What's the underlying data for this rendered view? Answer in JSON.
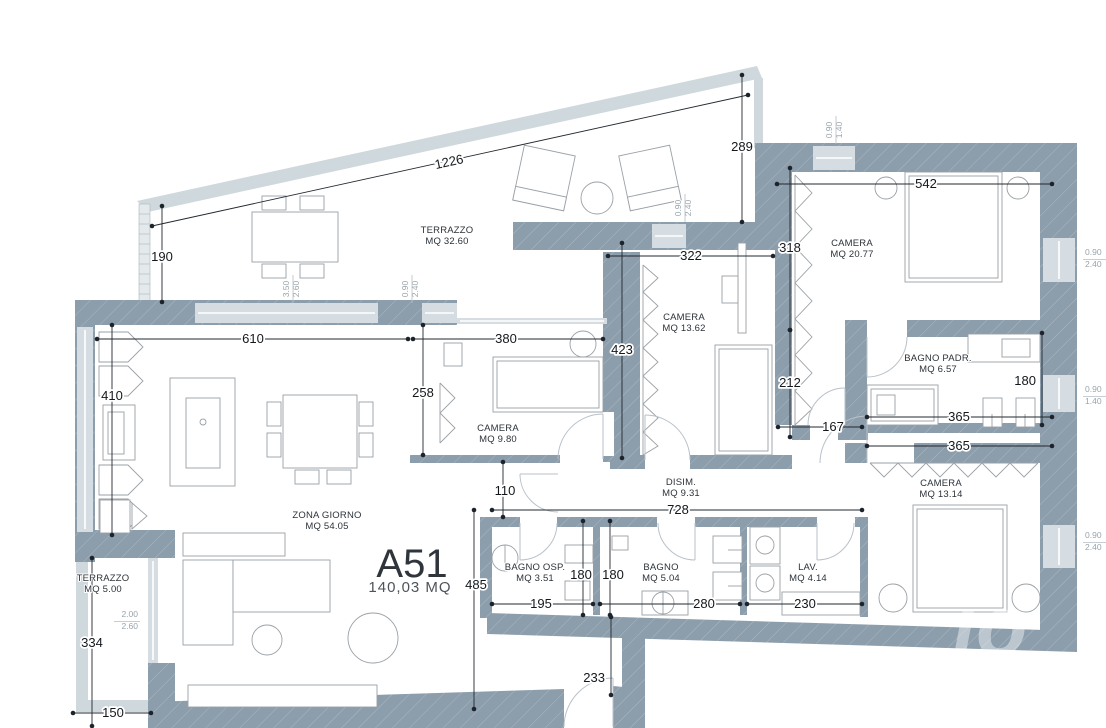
{
  "title": {
    "unit": "A51",
    "area": "140,03 MQ"
  },
  "watermark": {
    "text": "io"
  },
  "colors": {
    "wall": "#8c9dac",
    "glass": "#d6dde2",
    "parapet": "#cfd8dd",
    "dimension_line": "#22282e",
    "room_text": "#2c333a",
    "window_text": "#98a4ac"
  },
  "rooms": [
    {
      "name": "TERRAZZO",
      "area": "MQ 32.60",
      "x": 447,
      "y": 233
    },
    {
      "name": "CAMERA",
      "area": "MQ 20.77",
      "x": 852,
      "y": 246
    },
    {
      "name": "CAMERA",
      "area": "MQ 13.62",
      "x": 684,
      "y": 320
    },
    {
      "name": "CAMERA",
      "area": "MQ 9.80",
      "x": 498,
      "y": 431
    },
    {
      "name": "BAGNO PADR.",
      "area": "MQ 6.57",
      "x": 938,
      "y": 361
    },
    {
      "name": "CAMERA",
      "area": "MQ 13.14",
      "x": 941,
      "y": 486
    },
    {
      "name": "ZONA GIORNO",
      "area": "MQ 54.05",
      "x": 327,
      "y": 518
    },
    {
      "name": "DISIM.",
      "area": "MQ 9.31",
      "x": 681,
      "y": 485
    },
    {
      "name": "BAGNO OSP.",
      "area": "MQ 3.51",
      "x": 535,
      "y": 570
    },
    {
      "name": "BAGNO",
      "area": "MQ 5.04",
      "x": 661,
      "y": 570
    },
    {
      "name": "LAV.",
      "area": "MQ 4.14",
      "x": 808,
      "y": 570
    },
    {
      "name": "TERRAZZO",
      "area": "MQ 5.00",
      "x": 103,
      "y": 581
    }
  ],
  "dimensions": [
    {
      "label": "1226",
      "x1": 152,
      "y1": 226,
      "x2": 748,
      "y2": 95,
      "lx": 450,
      "ly": 166,
      "rot": -12.4
    },
    {
      "label": "190",
      "x1": 162,
      "y1": 206,
      "x2": 162,
      "y2": 302,
      "lx": 162,
      "ly": 261
    },
    {
      "label": "289",
      "x1": 742,
      "y1": 75,
      "x2": 742,
      "y2": 222,
      "lx": 742,
      "ly": 151
    },
    {
      "label": "542",
      "x1": 777,
      "y1": 184,
      "x2": 1052,
      "y2": 184,
      "lx": 926,
      "ly": 188
    },
    {
      "label": "318",
      "x1": 790,
      "y1": 168,
      "x2": 790,
      "y2": 330,
      "lx": 790,
      "ly": 252
    },
    {
      "label": "212",
      "x1": 790,
      "y1": 330,
      "x2": 790,
      "y2": 437,
      "lx": 790,
      "ly": 387
    },
    {
      "label": "322",
      "x1": 608,
      "y1": 256,
      "x2": 773,
      "y2": 256,
      "lx": 691,
      "ly": 260
    },
    {
      "label": "423",
      "x1": 622,
      "y1": 243,
      "x2": 622,
      "y2": 458,
      "lx": 622,
      "ly": 354
    },
    {
      "label": "167",
      "x1": 778,
      "y1": 427,
      "x2": 862,
      "y2": 427,
      "lx": 833,
      "ly": 431
    },
    {
      "label": "610",
      "x1": 97,
      "y1": 339,
      "x2": 408,
      "y2": 339,
      "lx": 253,
      "ly": 343
    },
    {
      "label": "380",
      "x1": 413,
      "y1": 339,
      "x2": 603,
      "y2": 339,
      "lx": 506,
      "ly": 343
    },
    {
      "label": "410",
      "x1": 112,
      "y1": 325,
      "x2": 112,
      "y2": 535,
      "lx": 112,
      "ly": 400
    },
    {
      "label": "258",
      "x1": 423,
      "y1": 325,
      "x2": 423,
      "y2": 455,
      "lx": 423,
      "ly": 397
    },
    {
      "label": "110",
      "x1": 503,
      "y1": 462,
      "x2": 503,
      "y2": 517,
      "lx": 505,
      "ly": 495
    },
    {
      "label": "728",
      "x1": 492,
      "y1": 510,
      "x2": 862,
      "y2": 510,
      "lx": 678,
      "ly": 514
    },
    {
      "label": "485",
      "x1": 474,
      "y1": 510,
      "x2": 474,
      "y2": 709,
      "lx": 476,
      "ly": 589
    },
    {
      "label": "195",
      "x1": 492,
      "y1": 604,
      "x2": 593,
      "y2": 604,
      "lx": 541,
      "ly": 608
    },
    {
      "label": "180",
      "x1": 583,
      "y1": 521,
      "x2": 583,
      "y2": 615,
      "lx": 581,
      "ly": 579
    },
    {
      "label": "180",
      "x1": 610,
      "y1": 521,
      "x2": 610,
      "y2": 615,
      "lx": 613,
      "ly": 579
    },
    {
      "label": "280",
      "x1": 600,
      "y1": 604,
      "x2": 740,
      "y2": 604,
      "lx": 704,
      "ly": 608
    },
    {
      "label": "230",
      "x1": 747,
      "y1": 604,
      "x2": 862,
      "y2": 604,
      "lx": 805,
      "ly": 608
    },
    {
      "label": "233",
      "x1": 611,
      "y1": 617,
      "x2": 611,
      "y2": 695,
      "lx": 605,
      "ly": 682,
      "anchor": "end"
    },
    {
      "label": "334",
      "x1": 92,
      "y1": 558,
      "x2": 92,
      "y2": 726,
      "lx": 92,
      "ly": 647
    },
    {
      "label": "150",
      "x1": 73,
      "y1": 713,
      "x2": 151,
      "y2": 713,
      "lx": 113,
      "ly": 717
    },
    {
      "label": "365",
      "x1": 867,
      "y1": 417,
      "x2": 1052,
      "y2": 417,
      "lx": 959,
      "ly": 421
    },
    {
      "label": "365",
      "x1": 867,
      "y1": 446,
      "x2": 1052,
      "y2": 446,
      "lx": 959,
      "ly": 450
    },
    {
      "label": "180",
      "x1": 1042,
      "y1": 333,
      "x2": 1042,
      "y2": 425,
      "lx": 1036,
      "ly": 385,
      "anchor": "end"
    }
  ],
  "window_labels": [
    {
      "top": "3.50",
      "bottom": "2.60",
      "x": 292,
      "y": 289,
      "orient": "v"
    },
    {
      "top": "0.90",
      "bottom": "2.40",
      "x": 411,
      "y": 289,
      "orient": "v"
    },
    {
      "top": "0.90",
      "bottom": "2.40",
      "x": 684,
      "y": 208,
      "orient": "v"
    },
    {
      "top": "0.90",
      "bottom": "1.40",
      "x": 835,
      "y": 130,
      "orient": "v"
    },
    {
      "top": "0.90",
      "bottom": "2.40",
      "x": 1085,
      "y": 258,
      "orient": "h"
    },
    {
      "top": "0.90",
      "bottom": "1.40",
      "x": 1085,
      "y": 395,
      "orient": "h"
    },
    {
      "top": "0.90",
      "bottom": "2.40",
      "x": 1085,
      "y": 541,
      "orient": "h"
    },
    {
      "top": "2.00",
      "bottom": "2.60",
      "x": 138,
      "y": 620,
      "orient": "h",
      "anchor": "end"
    }
  ]
}
